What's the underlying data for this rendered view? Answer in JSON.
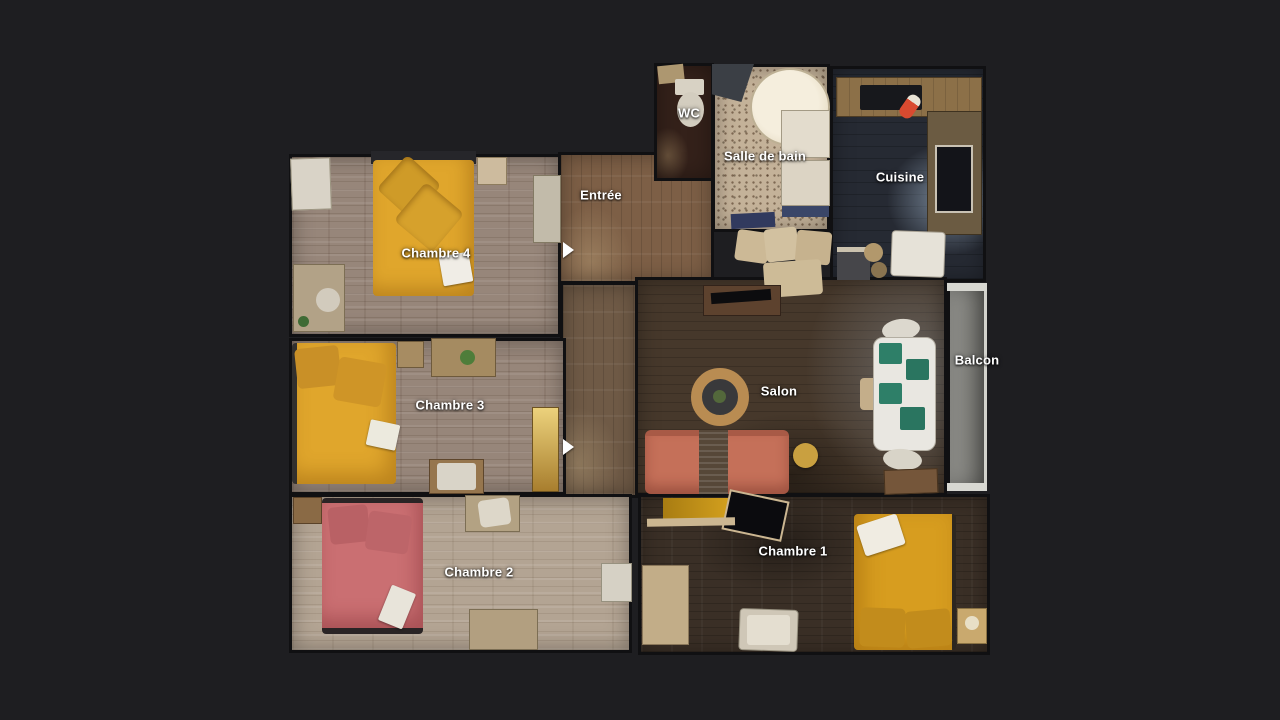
{
  "labels": {
    "wc": "WC",
    "salle_de_bain": "Salle de bain",
    "cuisine": "Cuisine",
    "entree": "Entrée",
    "chambre_4": "Chambre 4",
    "chambre_3": "Chambre 3",
    "chambre_2": "Chambre 2",
    "chambre_1": "Chambre 1",
    "salon": "Salon",
    "balcon": "Balcon"
  },
  "colors": {
    "bg": "#1e1e21",
    "wall": "#101012",
    "label-text": "#ffffff",
    "floor-gray-wood": "#97867a",
    "floor-beige-wood": "#b3a493",
    "floor-dark-wood": "#46382b",
    "floor-dark-wood-2": "#3a2f26",
    "floor-rust-wood": "#7d5f46",
    "floor-wc": "#34211a",
    "floor-bath": "#c4b299",
    "floor-kitchen": "#262a33",
    "bed-yellow": "#e0a62c",
    "bed-gold": "#d79d1f",
    "bed-pink": "#ca6f72",
    "sofa-salmon": "#c57059",
    "wood-counter": "#8c7048",
    "table-ring": "#b98c52",
    "placemat-green": "#2e7f68",
    "white-furniture": "#ddd7c9",
    "balcony-gray": "#8f8f8b"
  }
}
